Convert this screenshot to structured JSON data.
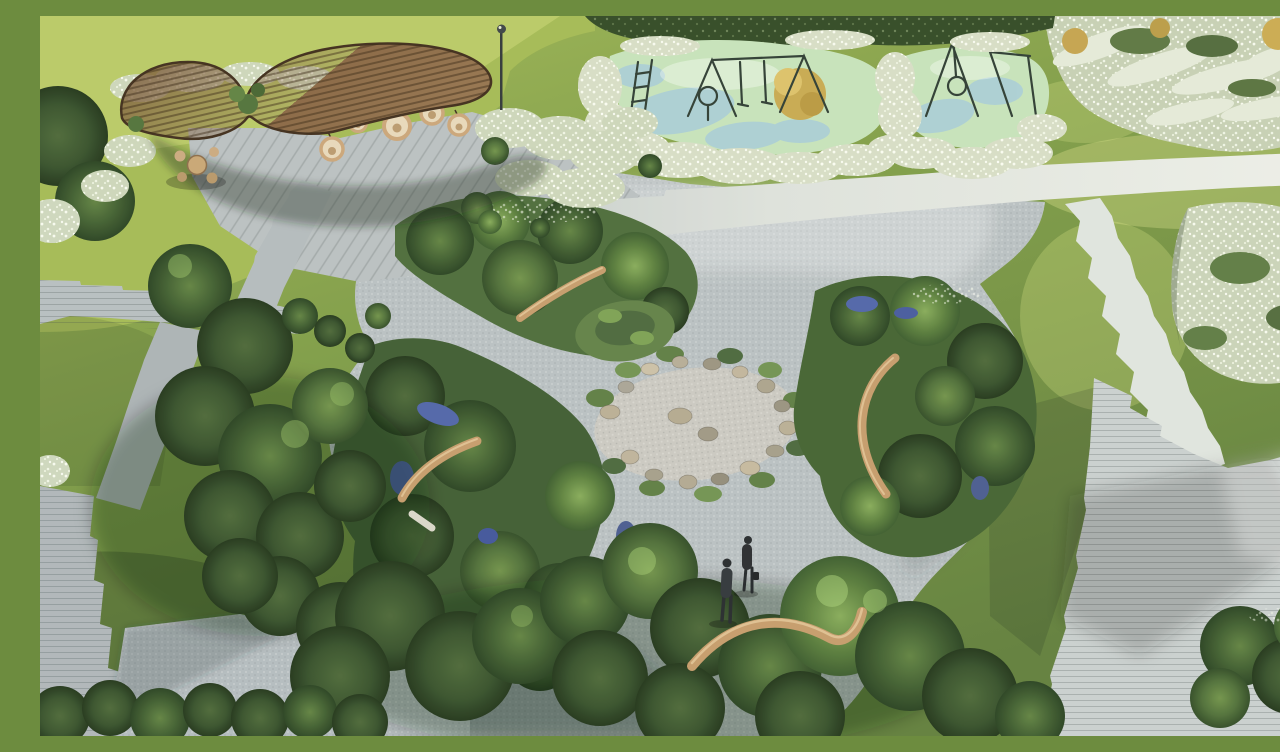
{
  "meta": {
    "title": "Aerial rendering of a residential landscape garden",
    "type": "3D architectural landscape rendering",
    "view": "aerial oblique, daytime sun from upper right"
  },
  "scene": {
    "description": "Bird's-eye rendering of a community garden: a curvy timber canopy with five hanging rattan egg chairs and an outdoor table set (top left), a children's playground with mint-green and blue safety surfacing, swing frames, a climbing ladder and a basket swing bordered by white plume grasses (top center), silvery-white flower fields (top right and mid right), a central naturalistic garden of dense shrub beds with blue salvia accents, curved timber benches and a winding grey paver path looping around a circular gravel clearing ringed with boulders, stepped stone paths crossing lawns on the left and lower right, and two people in dark suits walking on the central path.",
    "regions": [
      {
        "id": "canopy",
        "label": "Curved slatted timber canopy",
        "hanging_chairs": 5
      },
      {
        "id": "seating",
        "label": "Outdoor table with chairs under canopy"
      },
      {
        "id": "lamp",
        "label": "Park light pole"
      },
      {
        "id": "playground",
        "label": "Children's playground",
        "equipment": [
          "climbing ladder",
          "hoop post",
          "A-frame swing set",
          "basket swing frame",
          "side frame"
        ],
        "surface_colors": [
          "#c6e2ba",
          "#a6cbd8"
        ]
      },
      {
        "id": "flower-borders",
        "label": "White plume-grass flower borders"
      },
      {
        "id": "flower-field-top-right",
        "label": "Silver-white flower field with golden shrubs"
      },
      {
        "id": "flower-bed-right",
        "label": "White flower bed, mid right"
      },
      {
        "id": "central-garden",
        "label": "Central shrub beds with blue salvia and winding paver path"
      },
      {
        "id": "gravel-circle",
        "label": "Circular gravel clearing ringed with boulders"
      },
      {
        "id": "benches",
        "label": "Curved timber benches",
        "count": 4
      },
      {
        "id": "paths",
        "label": "Stepped stone paver paths and plazas"
      },
      {
        "id": "lawns",
        "label": "Lawn panels"
      },
      {
        "id": "people",
        "label": "Two people walking on the path",
        "count": 2
      }
    ],
    "palette": {
      "grass_sunlit": "#a9bf58",
      "grass_mid": "#7d9b45",
      "grass_shade": "#55713a",
      "foliage_dark": "#27401f",
      "foliage_mid": "#3c5a2d",
      "foliage_light": "#567a39",
      "flowers_white": "#dfe5d0",
      "flowers_blue": "#4d62a8",
      "paver_light": "#d3d8d4",
      "paver_mid": "#b8bfc2",
      "paver_shade": "#9aa3a7",
      "timber_canopy": "#7e5e40",
      "timber_bench": "#c49a6a",
      "playground_green": "#c6e2ba",
      "playground_blue": "#a6cbd8",
      "gravel": "#cac8c1",
      "shrub_gold": "#c7a84e"
    }
  }
}
